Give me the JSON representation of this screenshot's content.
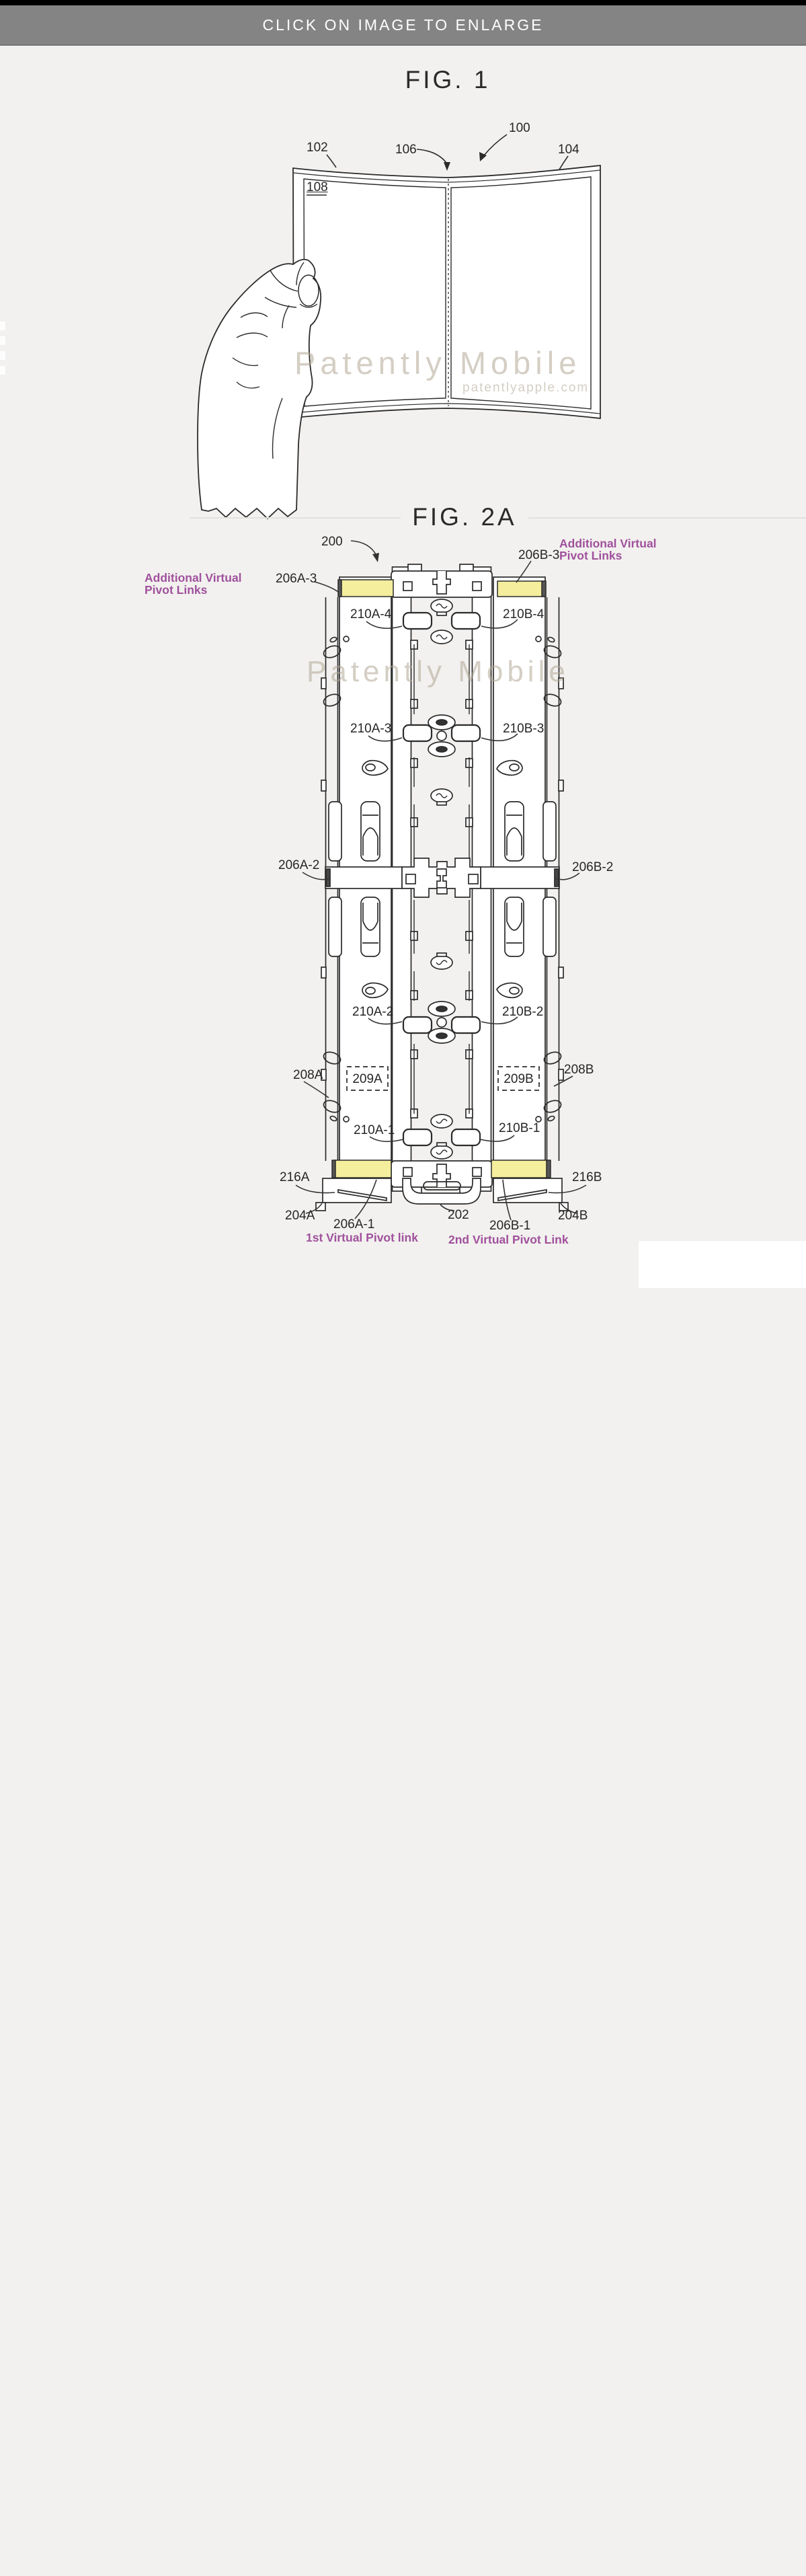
{
  "header": {
    "label": "CLICK ON IMAGE TO ENLARGE"
  },
  "fig1": {
    "title": "FIG. 1",
    "watermark": "Patently Mobile",
    "watermark_sub": "patentlyapple.com",
    "labels": {
      "n100": "100",
      "n102": "102",
      "n104": "104",
      "n106": "106",
      "n108": "108"
    }
  },
  "fig2a": {
    "title": "FIG. 2A",
    "watermark": "Patently Mobile",
    "annotation_color": "#a0519c",
    "highlight_color": "#f4ee9d",
    "annotations": {
      "left_top_line1": "Additional Virtual",
      "left_top_line2": "Pivot Links",
      "right_top_line1": "Additional Virtual",
      "right_top_line2": "Pivot Links",
      "bottom_left": "1st Virtual Pivot link",
      "bottom_right": "2nd Virtual Pivot Link"
    },
    "labels": {
      "n200": "200",
      "n206a3": "206A-3",
      "n206b3": "206B-3",
      "n210a4": "210A-4",
      "n210b4": "210B-4",
      "n210a3": "210A-3",
      "n210b3": "210B-3",
      "n206a2": "206A-2",
      "n206b2": "206B-2",
      "n210a2": "210A-2",
      "n210b2": "210B-2",
      "n208a": "208A",
      "n209a": "209A",
      "n209b": "209B",
      "n208b": "208B",
      "n210a1": "210A-1",
      "n210b1": "210B-1",
      "n216a": "216A",
      "n216b": "216B",
      "n204a": "204A",
      "n204b": "204B",
      "n206a1": "206A-1",
      "n206b1": "206B-1",
      "n202": "202"
    }
  },
  "footer_logo": {
    "site_name": "精选手游网",
    "site_url": "www.tzymjx.net",
    "colors": {
      "red": "#e23a3a",
      "blue": "#2d9ad8",
      "green": "#5cb43e",
      "orange": "#f2a71b",
      "yellow": "#f5d020"
    }
  }
}
